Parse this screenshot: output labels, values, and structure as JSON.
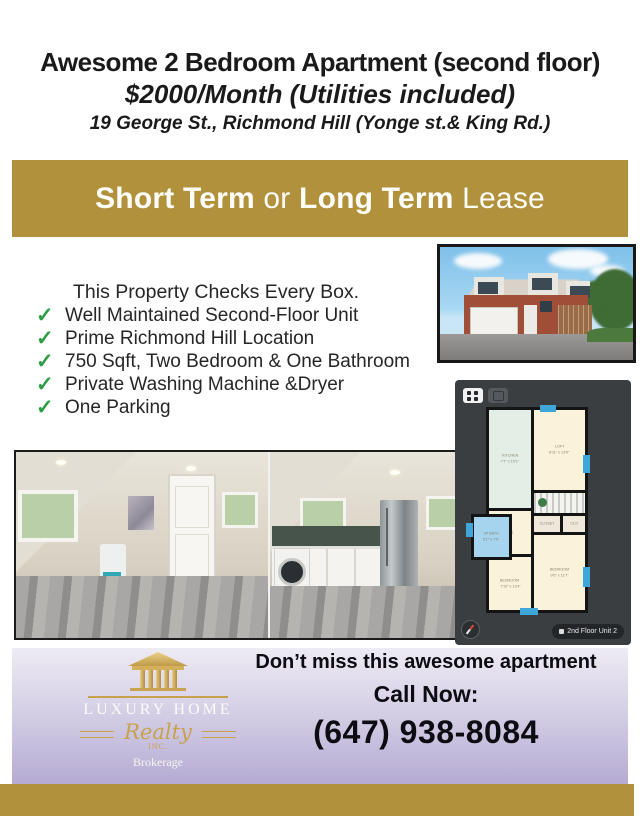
{
  "header": {
    "title": "Awesome 2 Bedroom Apartment (second floor)",
    "price_line": "$2000/Month (Utilities included)",
    "address_line": "19 George St., Richmond Hill (Yonge st.& King Rd.)"
  },
  "banner": {
    "short_term": "Short Term",
    "or": " or ",
    "long_term": "Long Term",
    "lease": " Lease",
    "bg_color": "#b2913c",
    "text_color": "#fdfdfa"
  },
  "checklist": {
    "intro": "This Property Checks Every Box.",
    "check_glyph": "✓",
    "check_color": "#2e9e44",
    "items": [
      "Well Maintained Second-Floor Unit",
      "Prime Richmond Hill Location",
      "750 Sqft, Two Bedroom & One Bathroom",
      "Private Washing Machine &Dryer",
      "One Parking"
    ]
  },
  "floorplan": {
    "panel_bg": "#3a3e41",
    "badge": "2nd Floor Unit 2",
    "room_colors": {
      "kitchen": "#e3efe6",
      "cream": "#faf3da",
      "bath": "#a6d4ee",
      "window": "#3fa6da"
    },
    "rooms": {
      "kitchen": {
        "name": "KITCHEN",
        "dims": "7'7\" x 15'1\""
      },
      "loft": {
        "name": "LOFT",
        "dims": "8'11\" x 13'9\""
      },
      "bath": {
        "name": "3P BATH",
        "dims": "5'1\" x 7'0\""
      },
      "hall": {
        "name": "HALL"
      },
      "closet": {
        "name": "CLOSET"
      },
      "clo": {
        "name": "CLO"
      },
      "bedroom_right": {
        "name": "BEDROOM",
        "dims": "9'6\" x 11'7\""
      },
      "bedroom_left": {
        "name": "BEDROOM",
        "dims": "7'10\" x 13'4\""
      }
    }
  },
  "footer": {
    "line1": "Don’t miss this awesome apartment",
    "line2": "Call Now:",
    "phone": "(647) 938-8084",
    "panel_top_color": "#edebf3",
    "panel_bottom_color": "#b5abd3",
    "logo": {
      "name": "LUXURY HOME",
      "script": "Realty",
      "inc": "INC.",
      "brokerage": "Brokerage",
      "gold": "#c7a24c"
    }
  }
}
